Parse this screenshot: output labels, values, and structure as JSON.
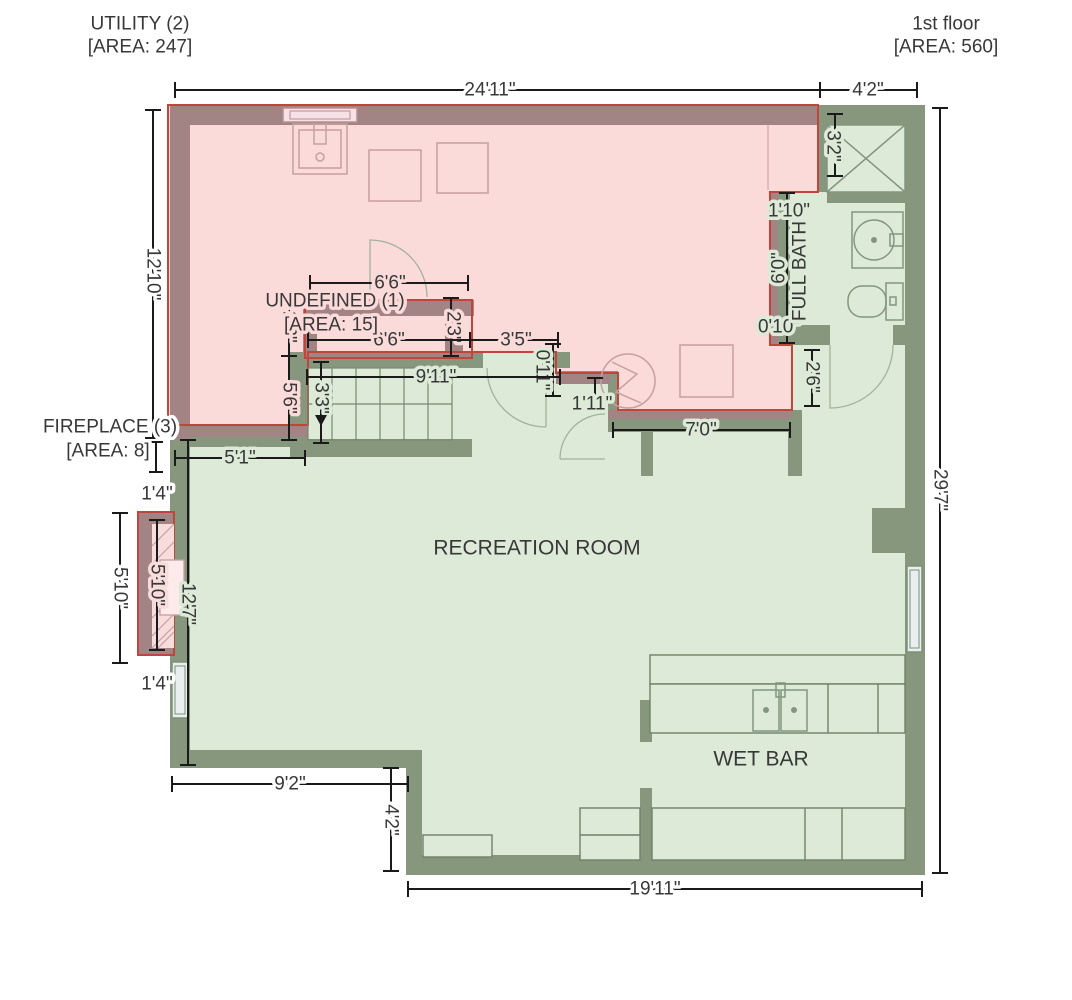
{
  "zone_labels": {
    "utility": {
      "name": "UTILITY (2)",
      "area": "[AREA: 247]"
    },
    "first_floor": {
      "name": "1st floor",
      "area": "[AREA: 560]"
    },
    "undefined": {
      "name": "UNDEFINED (1)",
      "area": "[AREA: 15]"
    },
    "fireplace": {
      "name": "FIREPLACE (3)",
      "area": "[AREA: 8]"
    }
  },
  "room_labels": {
    "recreation": "RECREATION ROOM",
    "wet_bar": "WET BAR",
    "full_bath": "FULL BATH"
  },
  "dimensions": {
    "top_width": "24'11\"",
    "bath_top_width": "4'2\"",
    "utility_left_height": "12'10\"",
    "right_height": "29'7\"",
    "shower_height": "3'2\"",
    "bath_wall_upper": "1'10\"",
    "bath_height": "6'0\"",
    "bath_wall_lower": "0'10\"",
    "bath_door_width": "2'6\"",
    "undefined_top_width": "6'6\"",
    "undefined_left_height": "2'3\"",
    "undefined_right_height": "2'3\"",
    "undefined_bottom_width": "6'6\"",
    "closet_width": "3'5\"",
    "hall_stub_width": "0'11\"",
    "stairs_width": "9'11\"",
    "stairs_left_height": "5'6\"",
    "stairs_run_height": "3'3\"",
    "alcove_width": "1'11\"",
    "mech_wall_width": "7'0\"",
    "rec_upper_left_width": "5'1\"",
    "fireplace_offset_top": "1'4\"",
    "fireplace_height_outer": "5'10\"",
    "fireplace_height_inner": "5'10\"",
    "rec_left_height": "12'7\"",
    "fireplace_offset_bottom": "1'4\"",
    "rec_bottom_left_width": "9'2\"",
    "step_height": "4'2\"",
    "bottom_width": "19'11\""
  },
  "colors": {
    "utility_zone_fill": "#fbdada",
    "zone_outline": "#c0453a",
    "utility_wall": "#a28484",
    "wall": "#87977d",
    "floor_fill": "#dcead7",
    "dimension_line": "#1a1a1a",
    "text": "#383838"
  }
}
